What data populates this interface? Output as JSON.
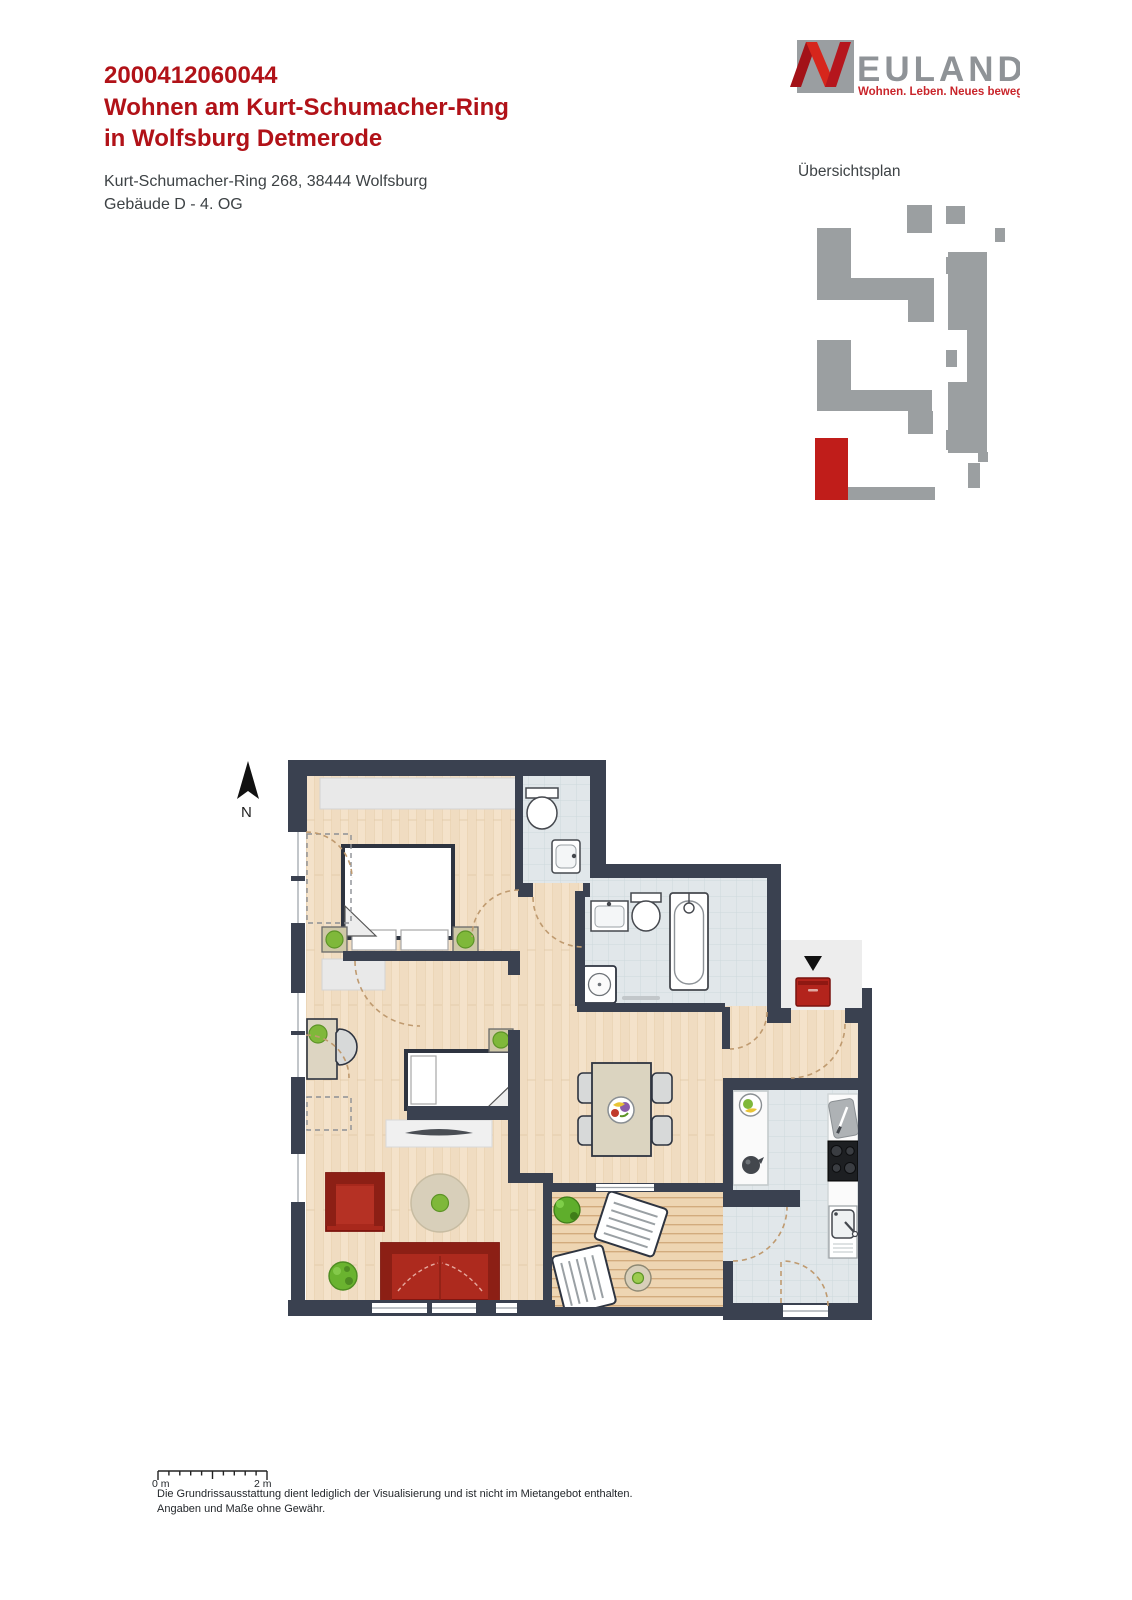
{
  "header": {
    "id": "2000412060044",
    "title1": "Wohnen am Kurt-Schumacher-Ring",
    "title2": "in Wolfsburg Detmerode",
    "address": "Kurt-Schumacher-Ring 268, 38444 Wolfsburg",
    "building": "Gebäude D - 4. OG"
  },
  "logo": {
    "wordmark": "EULAND",
    "tagline": "Wohnen. Leben. Neues bewegen."
  },
  "overview": {
    "label": "Übersichtsplan"
  },
  "floorplan": {
    "north_label": "N"
  },
  "scalebar": {
    "start": "0 m",
    "end": "2 m"
  },
  "disclaimer": {
    "line1": "Die Grundrissausstattung dient lediglich der Visualisierung und ist nicht im Mietangebot enthalten.",
    "line2": "Angaben und Maße ohne Gewähr."
  },
  "colors": {
    "brand_red": "#b11218",
    "text_dark": "#3d4245",
    "wall": "#3a4150",
    "logo_gray": "#9a9ea1",
    "logo_text_gray": "#8f9397",
    "logo_red": "#cc2127",
    "tagline_red": "#c9252b",
    "site_gray": "#9b9fa1",
    "site_red": "#c01d1a",
    "dash": "#bf9a6f",
    "outside": "#ededed",
    "wood_floor": "#f4e2ca",
    "tile_floor": "#e1e7ea",
    "deck_floor": "#eed5b2",
    "furniture_red": "#ad2a1e",
    "furniture_beige": "#dbd4c0",
    "plant_green": "#7fb83a"
  }
}
